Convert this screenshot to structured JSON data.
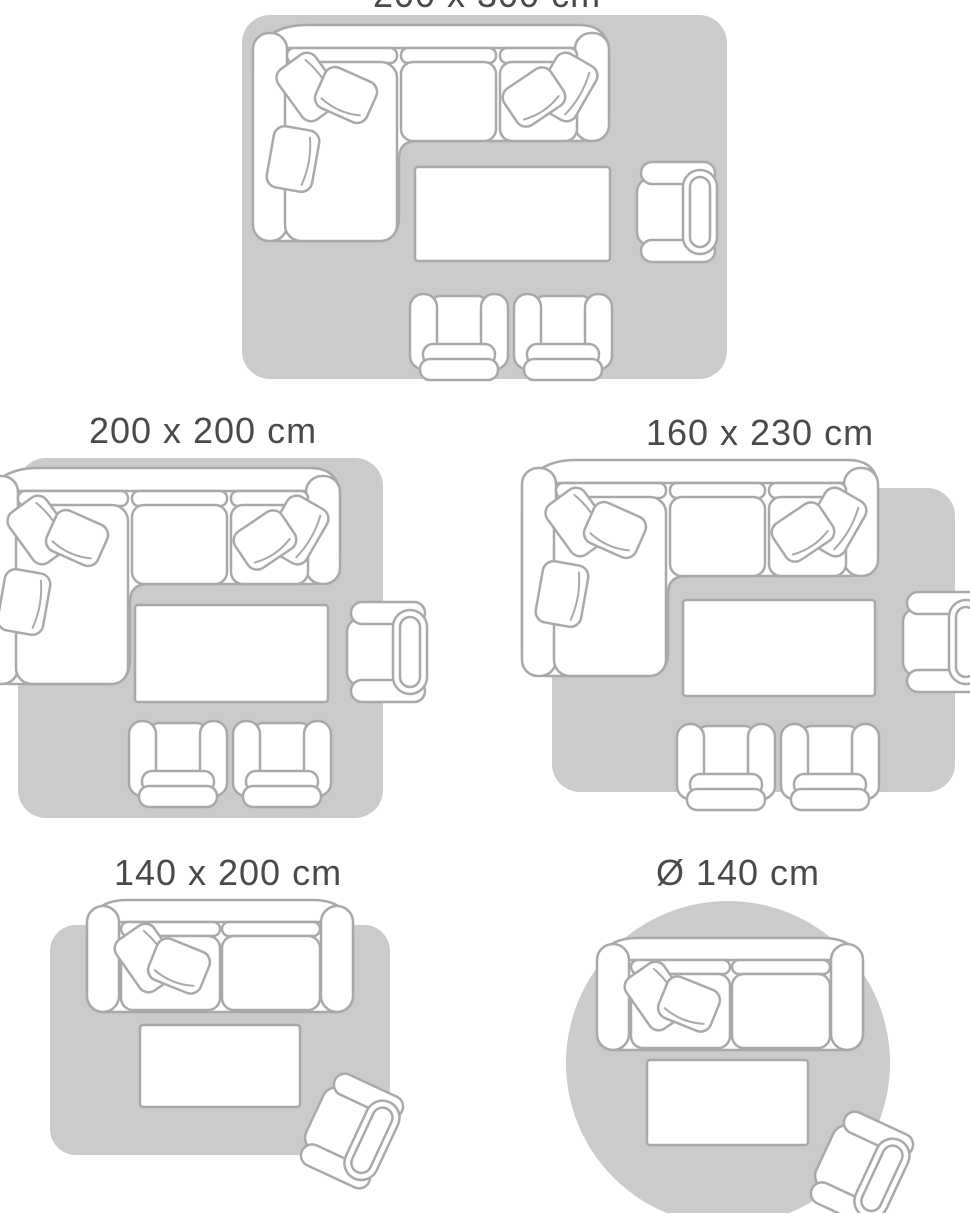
{
  "page": {
    "background": "#ffffff"
  },
  "colors": {
    "rug_fill": "#cbcbcb",
    "furniture_fill": "#ffffff",
    "furniture_outline": "#a9a9a9",
    "label_text": "#4a4a4a"
  },
  "size_guide": {
    "variants": [
      {
        "id": "200x300",
        "label": "200 x 300 cm",
        "rug_shape": "rectangle"
      },
      {
        "id": "200x200",
        "label": "200 x 200 cm",
        "rug_shape": "rectangle"
      },
      {
        "id": "160x230",
        "label": "160 x 230 cm",
        "rug_shape": "rectangle"
      },
      {
        "id": "140x200",
        "label": "140 x 200 cm",
        "rug_shape": "rectangle"
      },
      {
        "id": "diameter-140",
        "label": "Ø 140 cm",
        "rug_shape": "circle"
      }
    ]
  }
}
